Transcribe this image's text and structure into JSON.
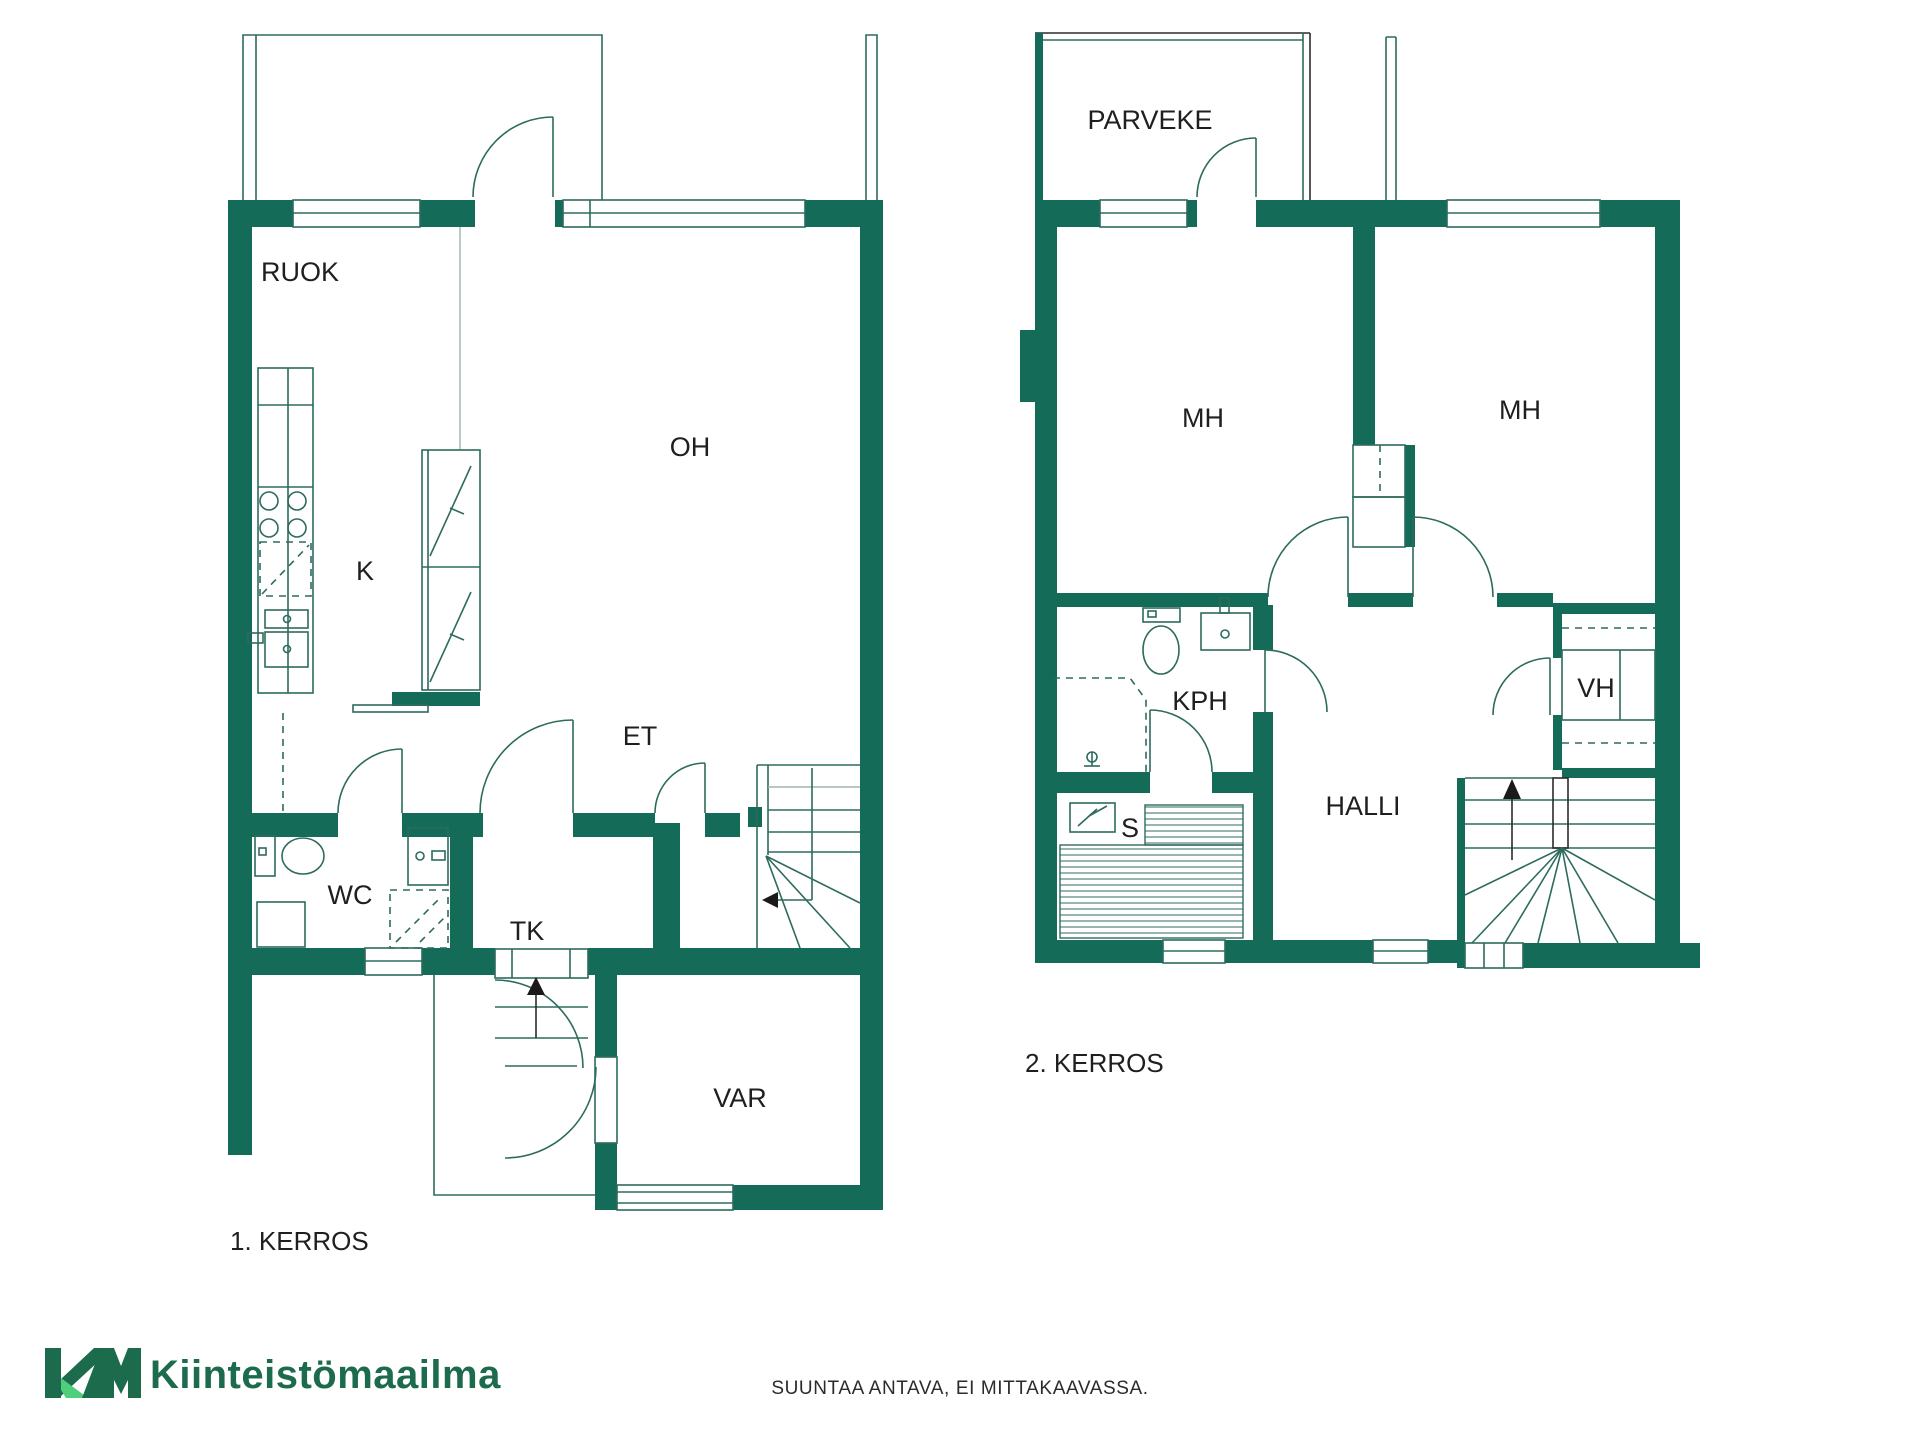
{
  "colors": {
    "wall": "#136b58",
    "fixture_line": "#2d6b5e",
    "light_line": "#9eb6af",
    "text": "#1f1f1f",
    "logo_dark": "#1c6b4d",
    "logo_light": "#4fce7d"
  },
  "floor1": {
    "caption": "1. KERROS",
    "rooms": {
      "ruok": "RUOK",
      "k": "K",
      "oh": "OH",
      "et": "ET",
      "wc": "WC",
      "tk": "TK",
      "var": "VAR"
    }
  },
  "floor2": {
    "caption": "2. KERROS",
    "rooms": {
      "parveke": "PARVEKE",
      "mh_left": "MH",
      "mh_right": "MH",
      "kph": "KPH",
      "vh": "VH",
      "halli": "HALLI",
      "s": "S"
    }
  },
  "footer": {
    "brand": "Kiinteistömaailma",
    "disclaimer": "SUUNTAA ANTAVA, EI MITTAKAAVASSA."
  }
}
